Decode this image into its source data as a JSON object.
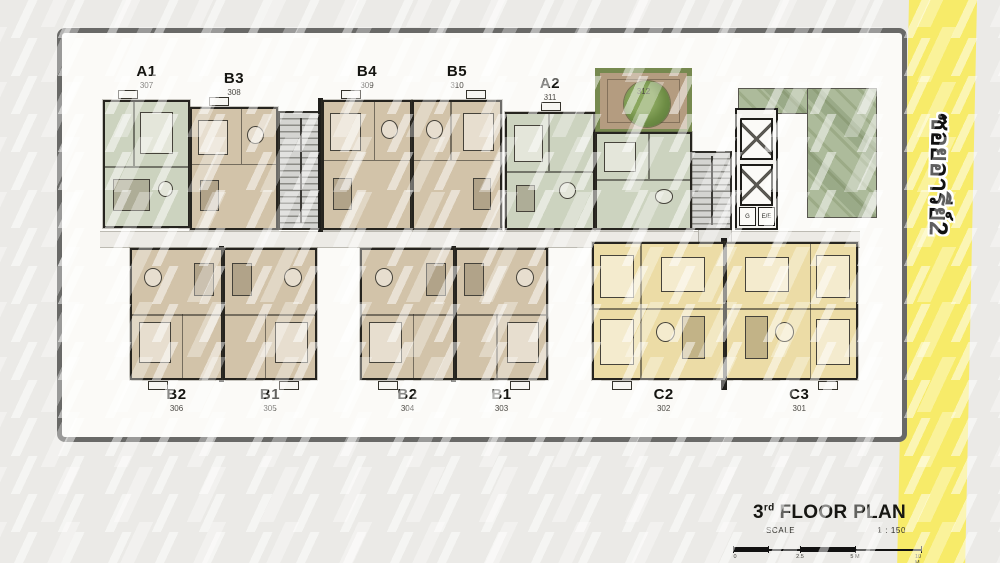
{
  "banner": {
    "text": "ซอยอารีย์2",
    "color": "#F7EB69"
  },
  "title": {
    "floor_number": "3",
    "ordinal": "rd",
    "text": "FLOOR PLAN",
    "scale_label": "SCALE",
    "scale_value": "1 : 150"
  },
  "scale_bar": {
    "ticks": [
      "0",
      "2.5",
      "5 M",
      "10 M"
    ]
  },
  "units": [
    {
      "name": "A1",
      "number": "307"
    },
    {
      "name": "B3",
      "number": "308"
    },
    {
      "name": "B4",
      "number": "309"
    },
    {
      "name": "B5",
      "number": "310"
    },
    {
      "name": "A2",
      "number": "311"
    },
    {
      "name": "B2",
      "number": "306"
    },
    {
      "name": "B1",
      "number": "305"
    },
    {
      "name": "B2",
      "number": "304"
    },
    {
      "name": "B1",
      "number": "303"
    },
    {
      "name": "C2",
      "number": "302"
    },
    {
      "name": "C3",
      "number": "301"
    }
  ],
  "courtyard": {
    "number": "312"
  },
  "elevator": {
    "label": "E/E",
    "service_label": "G"
  },
  "colors": {
    "unit_tan": "#D2C3A9",
    "unit_green": "#CCD3BF",
    "unit_cream": "#ECDCA6",
    "roof_garden": "#ADBB9B",
    "banner_yellow": "#F7EB69",
    "plan_background": "#FBFAF7"
  }
}
